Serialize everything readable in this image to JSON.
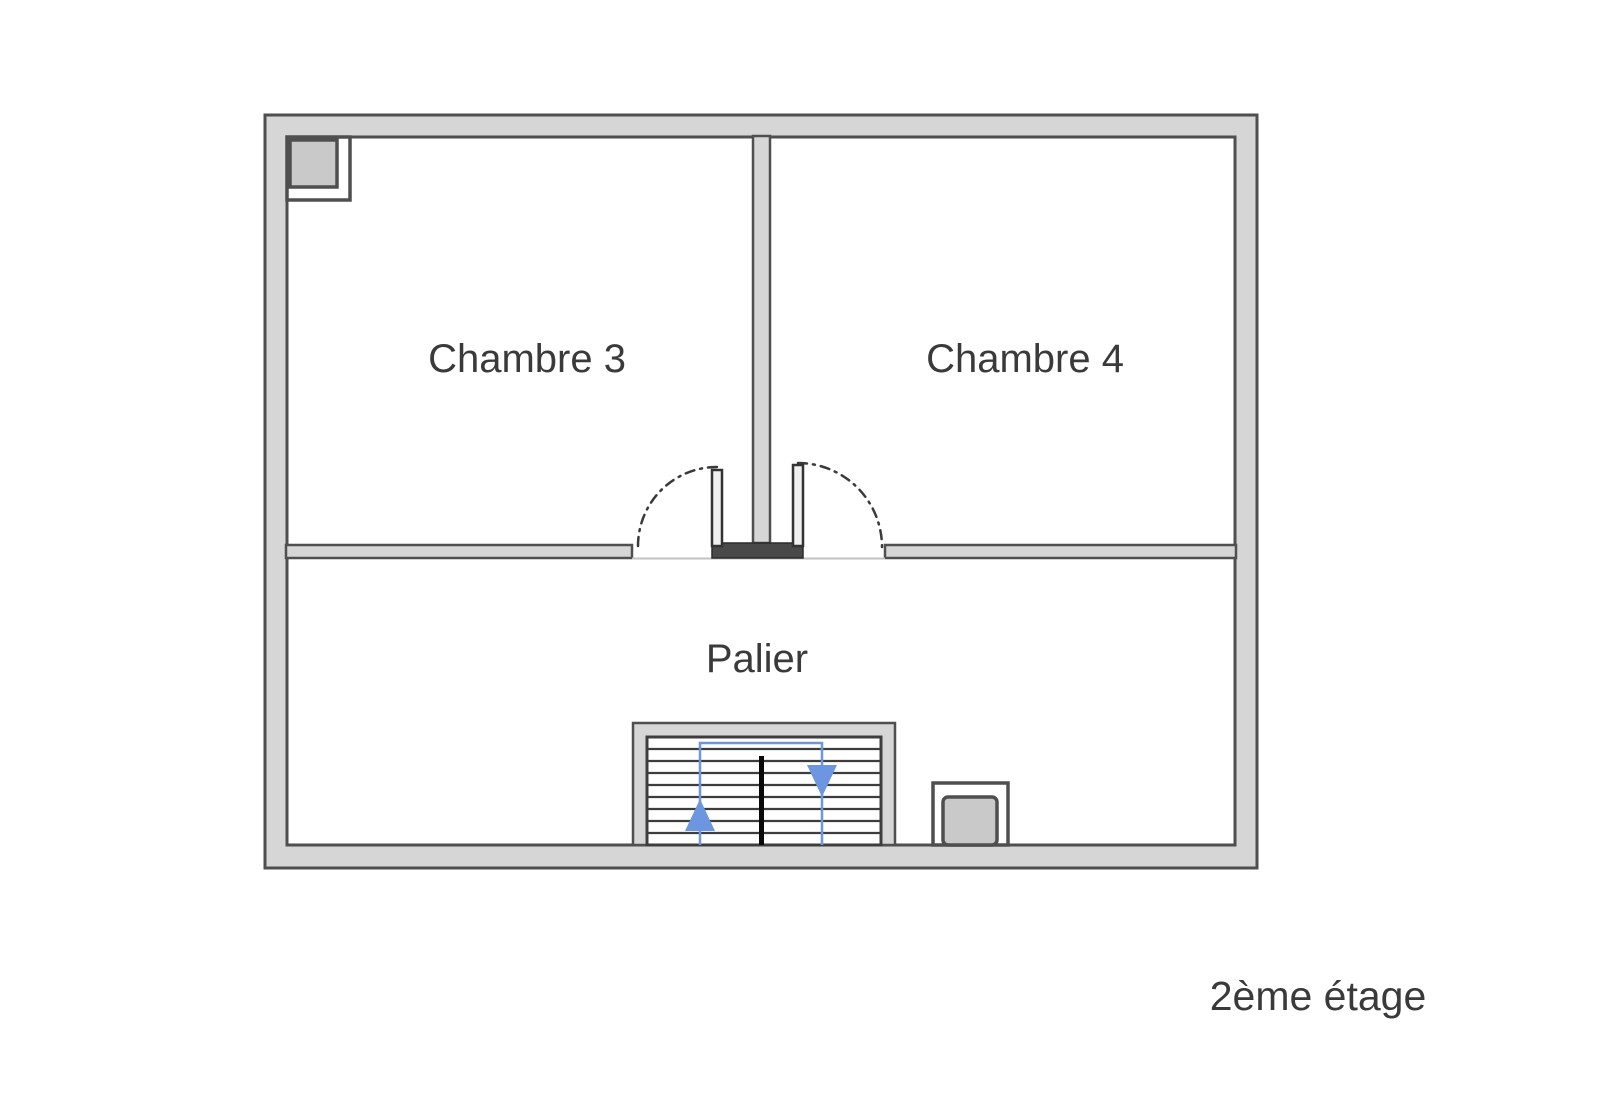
{
  "floor_plan": {
    "rooms": {
      "chambre3": {
        "label": "Chambre 3"
      },
      "chambre4": {
        "label": "Chambre 4"
      },
      "palier": {
        "label": "Palier"
      }
    },
    "floor": {
      "label": "2ème étage"
    },
    "icons": {
      "stairs_up": "arrow-up",
      "stairs_down": "arrow-down"
    },
    "colors": {
      "wall_fill": "#d6d6d6",
      "wall_stroke": "#4f4f4f",
      "tread_stroke": "#3d3d3d",
      "stair_path": "#6d96e0",
      "text": "#3a3a3a",
      "duct_fill": "#c9c9c9",
      "background": "#ffffff"
    }
  }
}
